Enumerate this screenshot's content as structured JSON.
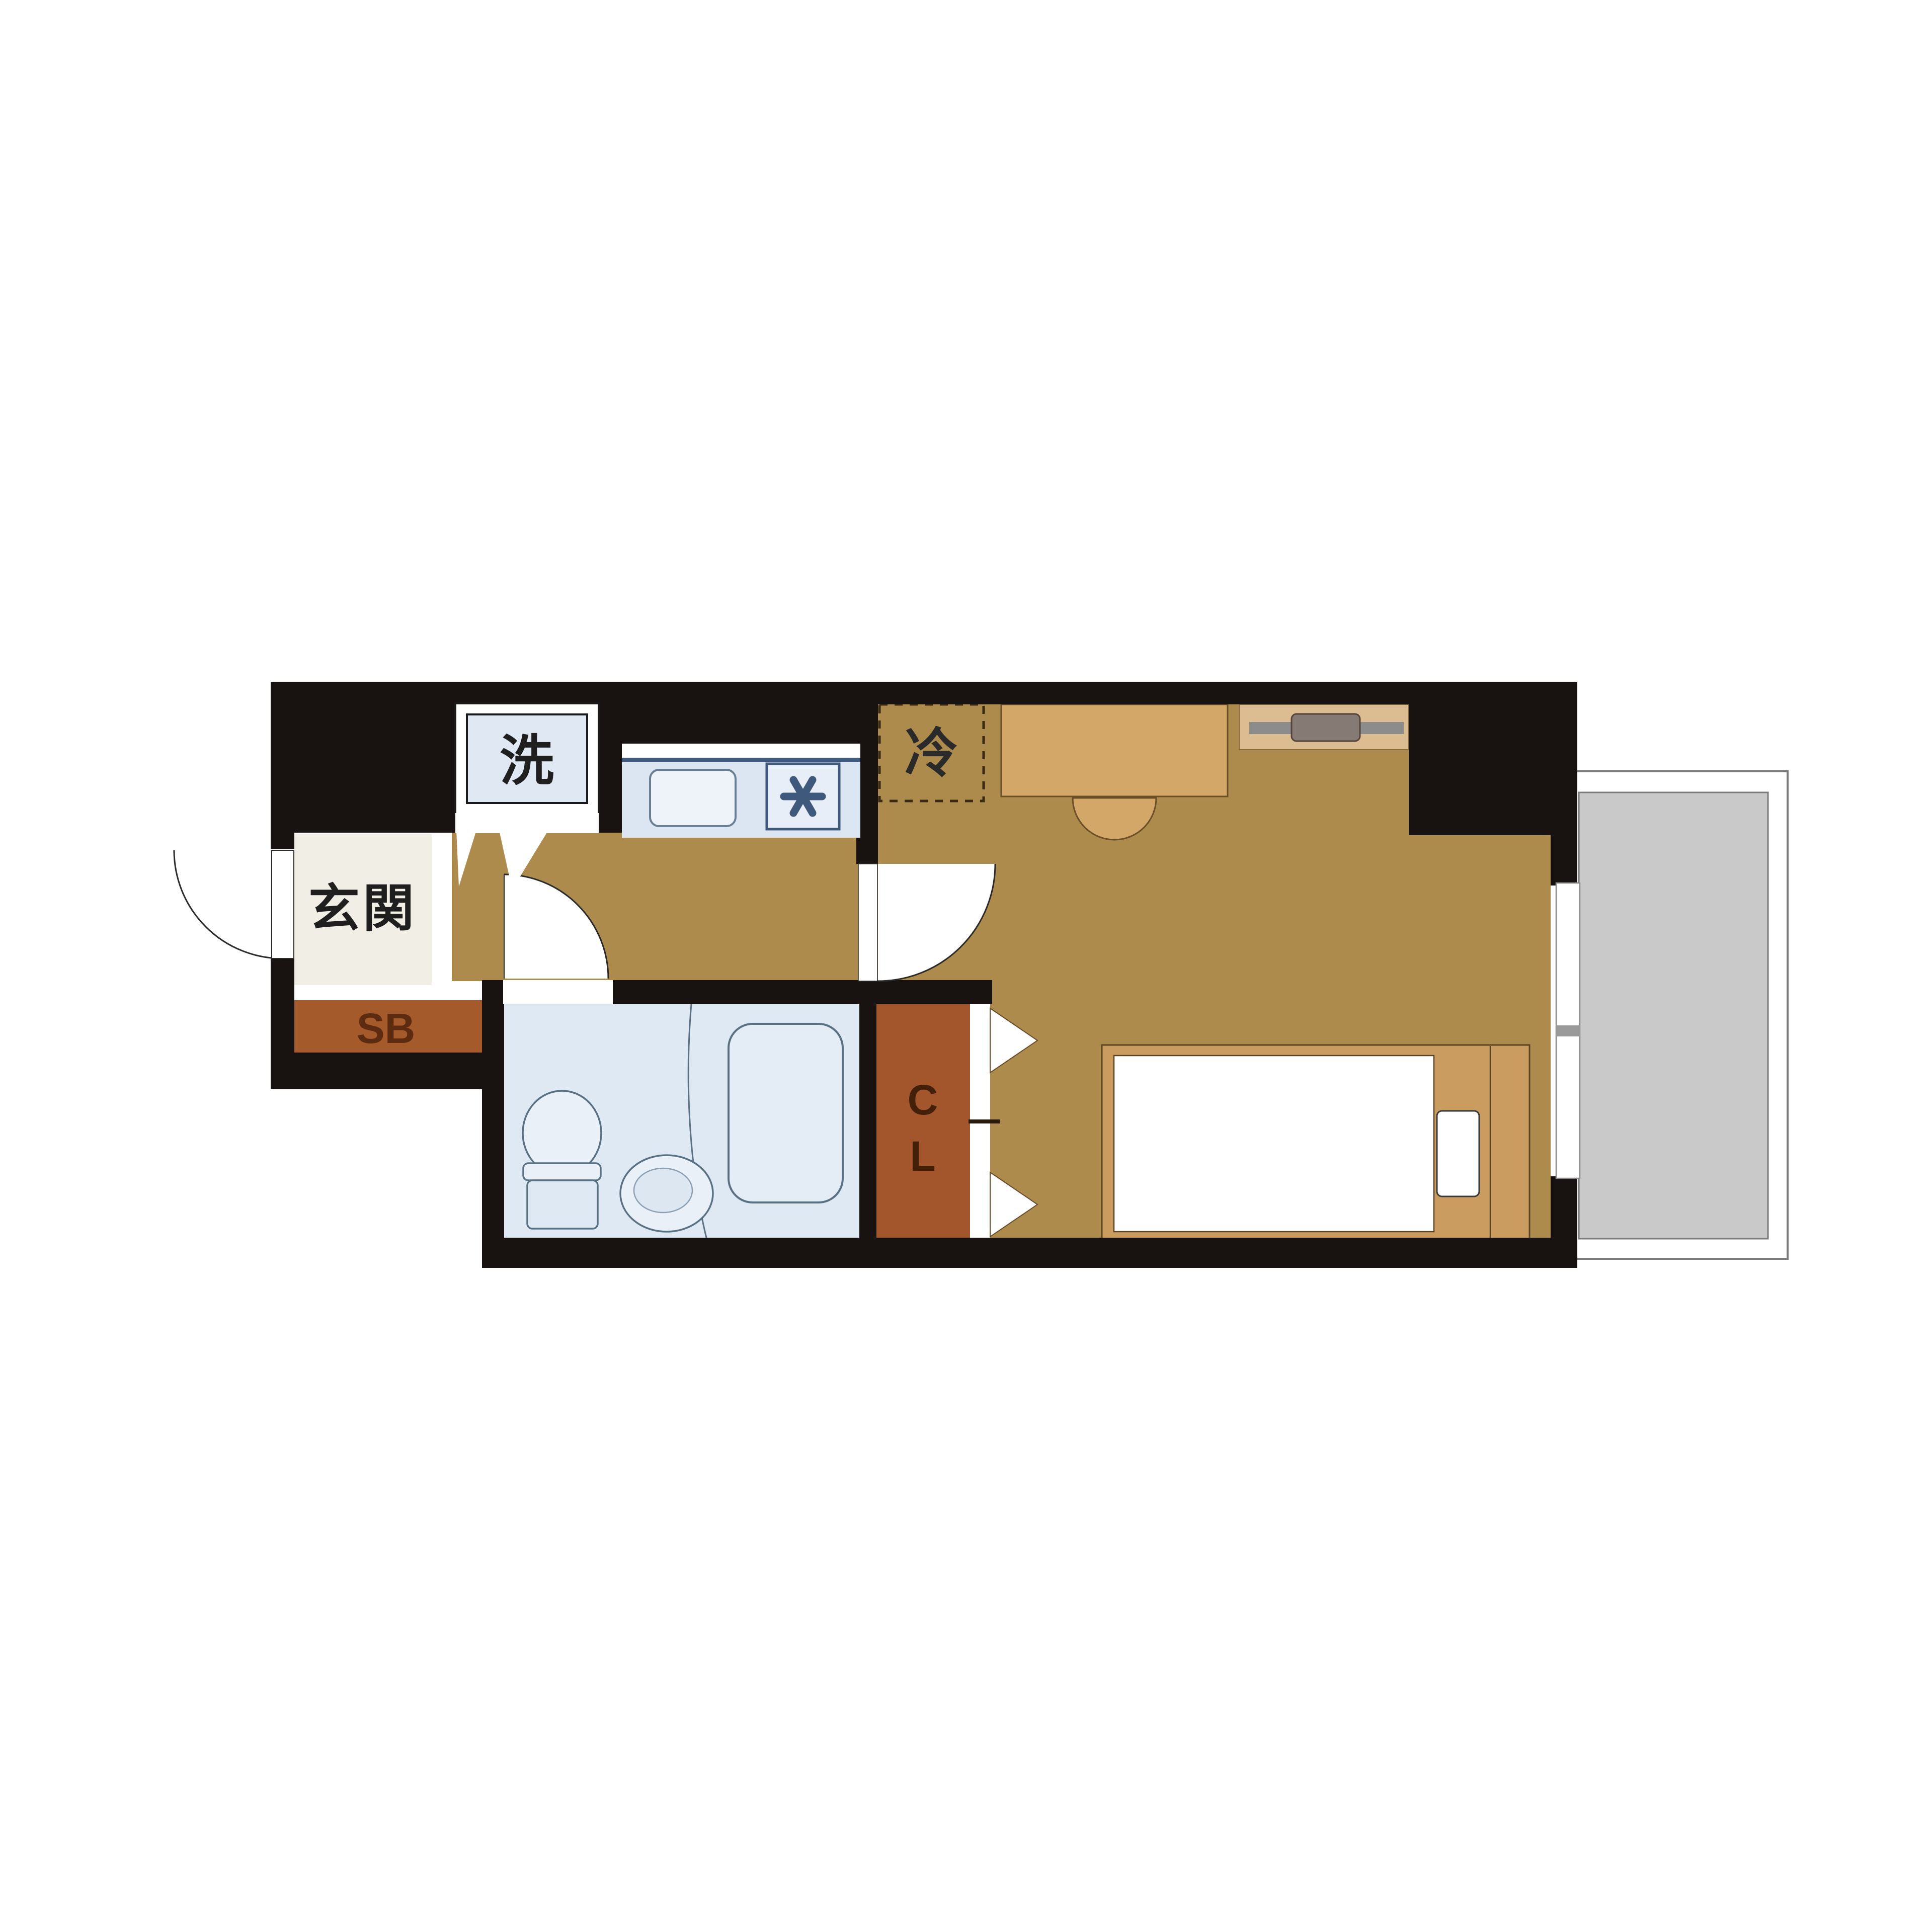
{
  "floorplan": {
    "labels": {
      "washer": "洗",
      "entrance": "玄関",
      "shoe_box": "SB",
      "refrigerator": "冷",
      "closet_c": "C",
      "closet_l": "L"
    },
    "colors": {
      "wall": "#181310",
      "floor_tan": "#ad8b4d",
      "entrance_floor": "#f1eee6",
      "storage_brown": "#a3562c",
      "storage_text": "#5c2b10",
      "bath_blue": "#dfe9f4",
      "fixture_fill": "#e9f0f8",
      "fixture_stroke": "#5a7184",
      "counter_blue": "#dce6f2",
      "counter_accent": "#3f597c",
      "furniture_tan": "#d2a768",
      "furniture_stroke": "#6b4f28",
      "shelf_tan": "#dcbd92",
      "bed_frame": "#cb9c5f",
      "balcony_gray": "#c9c9c9",
      "balcony_line": "#7a7a7a",
      "label_text": "#1f1f1f"
    }
  }
}
